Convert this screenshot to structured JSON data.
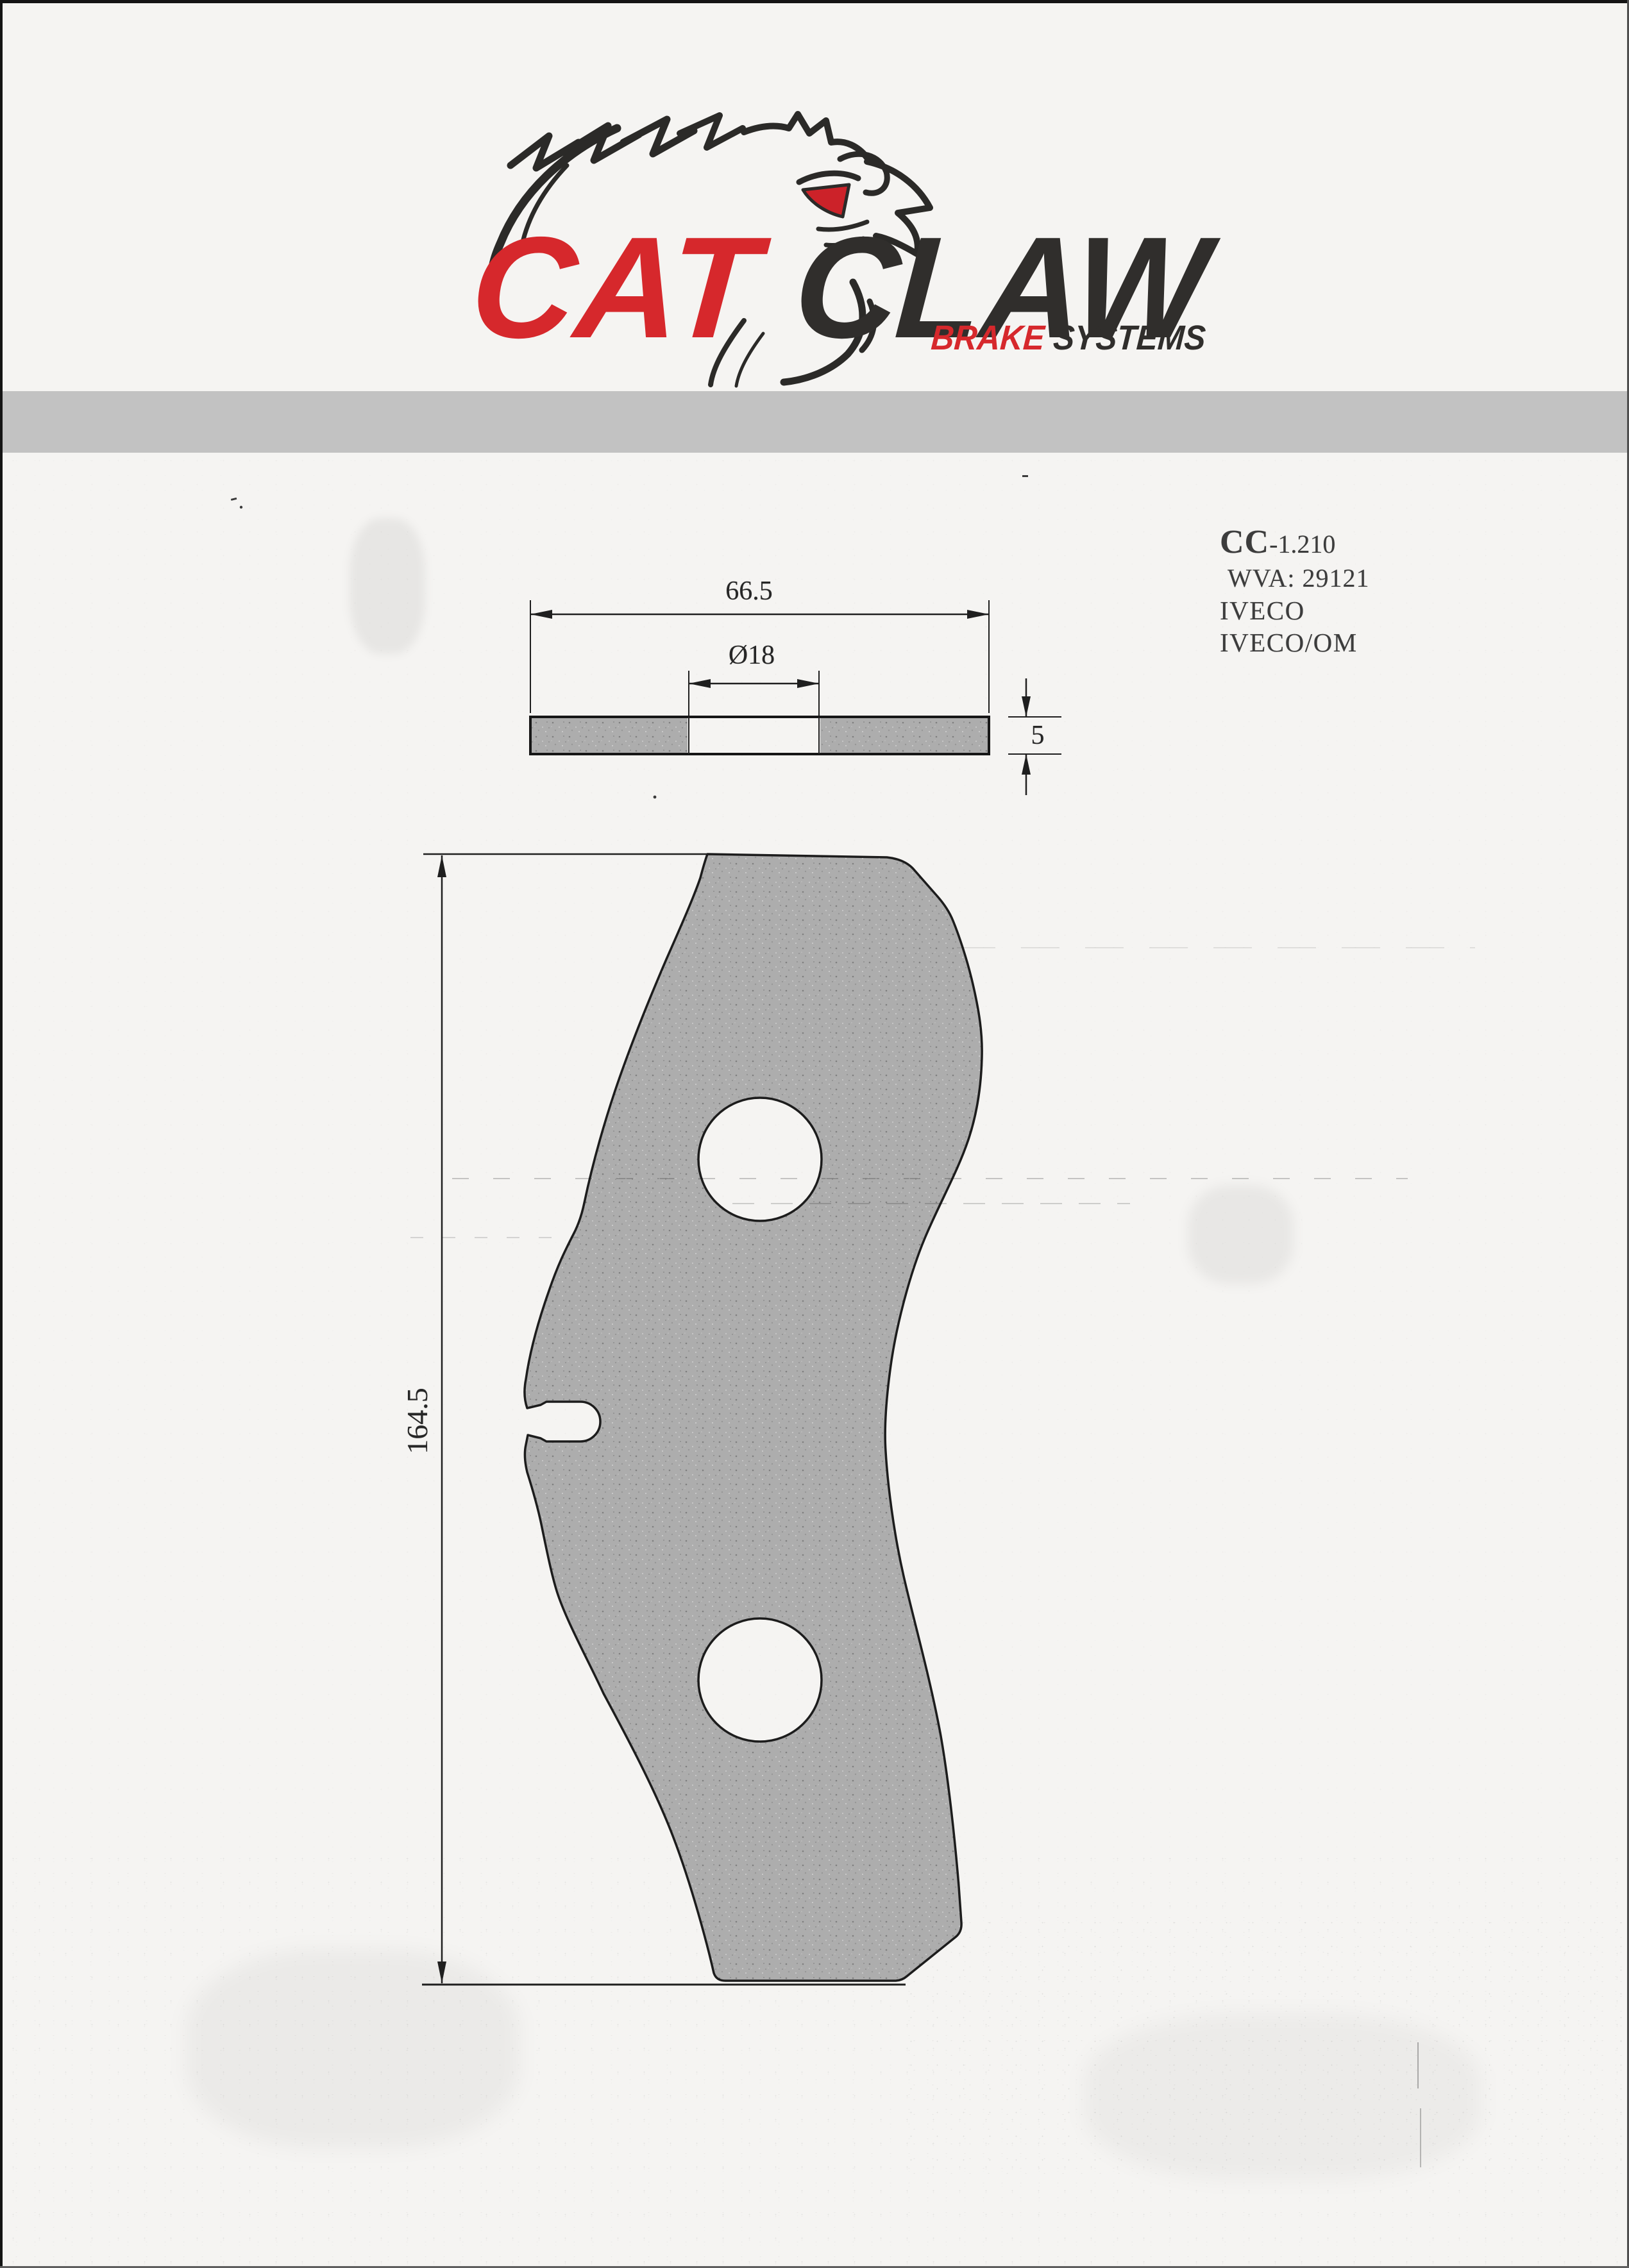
{
  "logo": {
    "cat": "CAT",
    "claw_c": "C",
    "law": "LAW",
    "brake": "BRAKE",
    "systems": " SYSTEMS",
    "red": "#d6282c",
    "dark": "#302e2c"
  },
  "part_info": {
    "code_prefix": "CC",
    "code_suffix": "-1.210",
    "wva": "WVA: 29121",
    "application_1": "IVECO",
    "application_2": "IVECO/OM"
  },
  "drawing": {
    "dimensions": {
      "width_mm": "66.5",
      "hole_diameter": "Ø18",
      "thickness_mm": "5",
      "height_mm": "164.5"
    },
    "line_color": "#1f1f1f",
    "fill_color": "#adadad",
    "separator_color": "#c2c2c2"
  }
}
